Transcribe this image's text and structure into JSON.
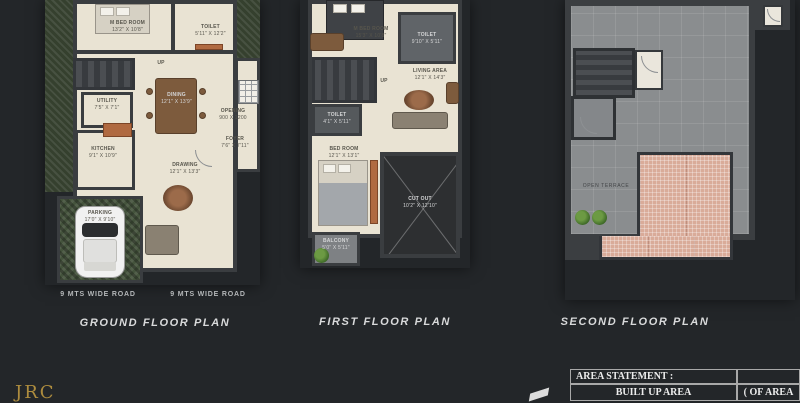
{
  "canvas": {
    "background": "#232629"
  },
  "plans": {
    "ground": {
      "title": "GROUND FLOOR PLAN",
      "road_left": "9 MTS WIDE ROAD",
      "road_right": "9 MTS WIDE ROAD",
      "rooms": {
        "mbed": {
          "name": "M BED ROOM",
          "dims": "13'2\" X 10'8\""
        },
        "toilet": {
          "name": "TOILET",
          "dims": "5'11\" X 12'2\""
        },
        "dining": {
          "name": "DINING",
          "dims": "12'1\" X 13'9\""
        },
        "utility": {
          "name": "UTILITY",
          "dims": "7'5\" X 7'1\""
        },
        "kitchen": {
          "name": "KITCHEN",
          "dims": "9'1\" X 10'9\""
        },
        "drawing": {
          "name": "DRAWING",
          "dims": "12'1\" X 13'3\""
        },
        "parking": {
          "name": "PARKING",
          "dims": "17'0\" X 9'10\""
        },
        "opening": {
          "name": "OPENING",
          "dims": "900 X 1200"
        },
        "foyer": {
          "name": "FOYER",
          "dims": "7'6\" X 7'11\""
        },
        "up": {
          "name": "UP"
        }
      }
    },
    "first": {
      "title": "FIRST FLOOR PLAN",
      "rooms": {
        "mbed": {
          "name": "M BED ROOM",
          "dims": "15'3\" X 10'8\""
        },
        "toilet1": {
          "name": "TOILET",
          "dims": "9'10\" X 5'11\""
        },
        "living": {
          "name": "LIVING AREA",
          "dims": "12'1\" X 14'3\""
        },
        "toilet2": {
          "name": "TOILET",
          "dims": "4'1\" X 5'11\""
        },
        "bed": {
          "name": "BED ROOM",
          "dims": "12'1\" X 13'1\""
        },
        "cutout": {
          "name": "CUT OUT",
          "dims": "10'2\" X 12'10\""
        },
        "balcony": {
          "name": "BALCONY",
          "dims": "5'0\" X 5'11\""
        },
        "up": {
          "name": "UP"
        }
      }
    },
    "second": {
      "title": "SECOND FLOOR PLAN",
      "rooms": {
        "terrace": {
          "name": "OPEN TERRACE"
        }
      }
    }
  },
  "footer": {
    "logo": "JRC",
    "area_table": {
      "header": "AREA STATEMENT :",
      "row_label": "BUILT UP AREA",
      "col_label": "( OF AREA"
    }
  }
}
